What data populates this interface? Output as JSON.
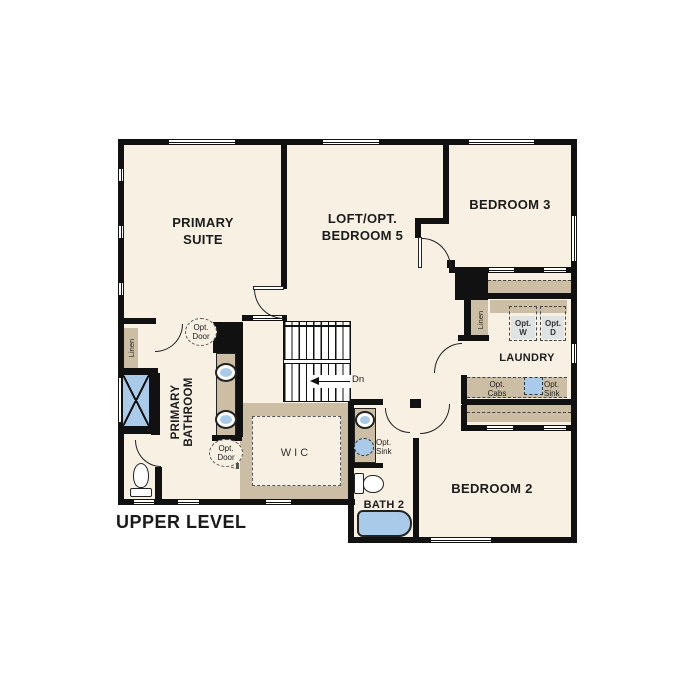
{
  "title": "UPPER LEVEL",
  "colors": {
    "floor": "#f8f0e2",
    "wall": "#111111",
    "counter": "#ccbea4",
    "fixture": "#a9cbe9",
    "appliance": "#e0e3e3"
  },
  "rooms": {
    "primary_suite": {
      "name_line1": "PRIMARY",
      "name_line2": "SUITE"
    },
    "loft": {
      "name_line1": "LOFT/OPT.",
      "name_line2": "BEDROOM 5"
    },
    "bedroom3": {
      "name": "BEDROOM 3"
    },
    "bedroom2": {
      "name": "BEDROOM 2"
    },
    "laundry": {
      "name": "LAUNDRY"
    },
    "bath2": {
      "name": "BATH 2"
    },
    "wic": {
      "name": "WIC"
    },
    "primary_bathroom": {
      "name_line1": "PRIMARY",
      "name_line2": "BATHROOM"
    }
  },
  "labels": {
    "linen_left": "Linen",
    "linen_right": "Linen",
    "opt_door_upper": {
      "line1": "Opt.",
      "line2": "Door"
    },
    "opt_door_lower": {
      "line1": "Opt.",
      "line2": "Door"
    },
    "opt_washer": {
      "line1": "Opt.",
      "line2": "W"
    },
    "opt_dryer": {
      "line1": "Opt.",
      "line2": "D"
    },
    "opt_cabs": {
      "line1": "Opt.",
      "line2": "Cabs"
    },
    "opt_sink_laundry": {
      "line1": "Opt.",
      "line2": "Sink"
    },
    "opt_sink_bath2": {
      "line1": "Opt.",
      "line2": "Sink"
    },
    "stair_direction": "Dn"
  }
}
